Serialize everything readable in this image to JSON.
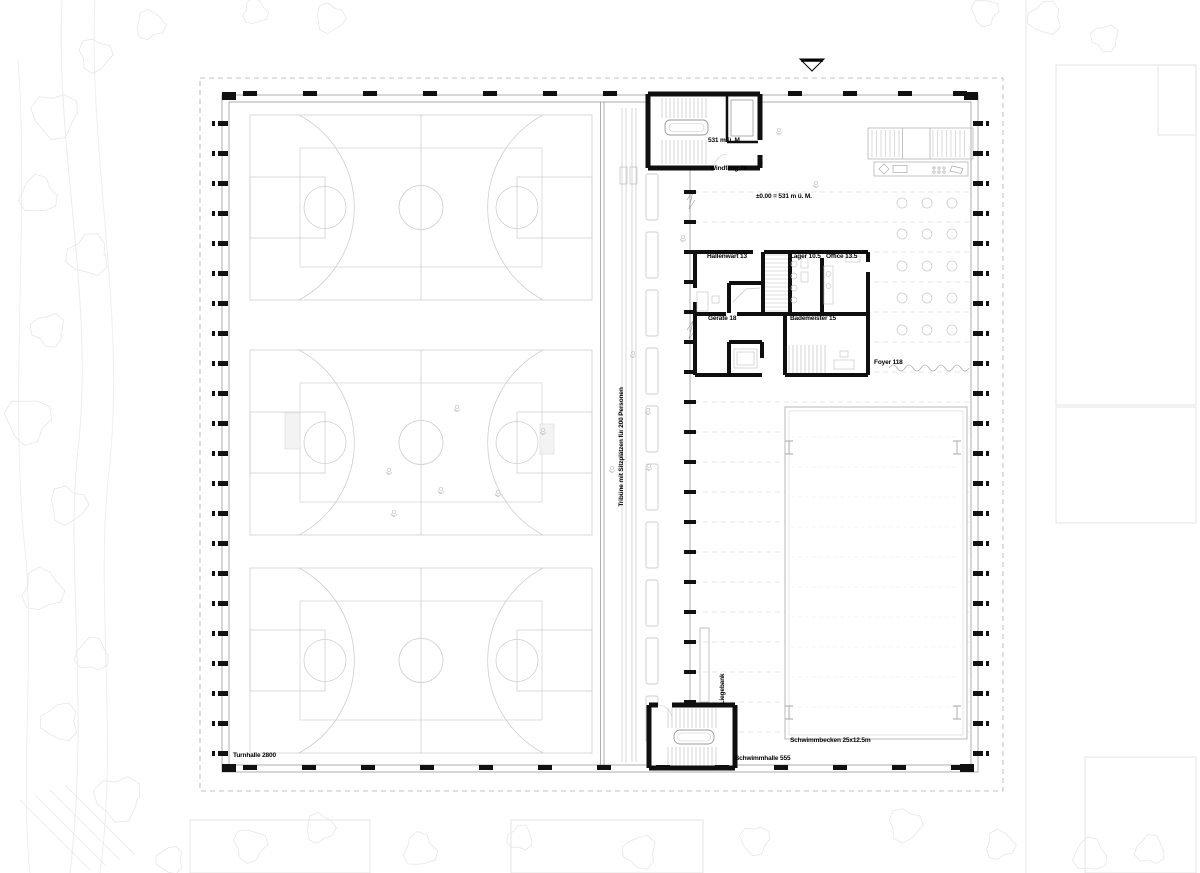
{
  "drawing": {
    "type": "architectural-floor-plan",
    "labels": {
      "turnhalle": {
        "text": "Turnhalle 2800"
      },
      "tribuene": {
        "text": "Tribüne mit Sitzplätzen für 200 Personen"
      },
      "level_entry": {
        "text": "531 m ü. M."
      },
      "windfang": {
        "text": "Windfang 78"
      },
      "level_main": {
        "text": "±0.00 = 531 m ü. M."
      },
      "hallenwart": {
        "text": "Hallenwart 13"
      },
      "lager": {
        "text": "Lager 10.5"
      },
      "office": {
        "text": "Office 13.5"
      },
      "geraete": {
        "text": "Geräte 18"
      },
      "bademeister": {
        "text": "Bademeister 15"
      },
      "foyer": {
        "text": "Foyer 118"
      },
      "liegebank": {
        "text": "Liegebank"
      },
      "schwimmbecken": {
        "text": "Schwimmbecken 25x12.5m"
      },
      "schwimmhalle": {
        "text": "Schwimmhalle 555"
      }
    },
    "symbols": {
      "entrance_marker": "triangle-down"
    },
    "colors": {
      "walls": "#111111",
      "thin_lines": "#9a9a9a",
      "court_lines": "#cfcfcf",
      "context": "#e9e9e9",
      "background": "#ffffff"
    }
  }
}
